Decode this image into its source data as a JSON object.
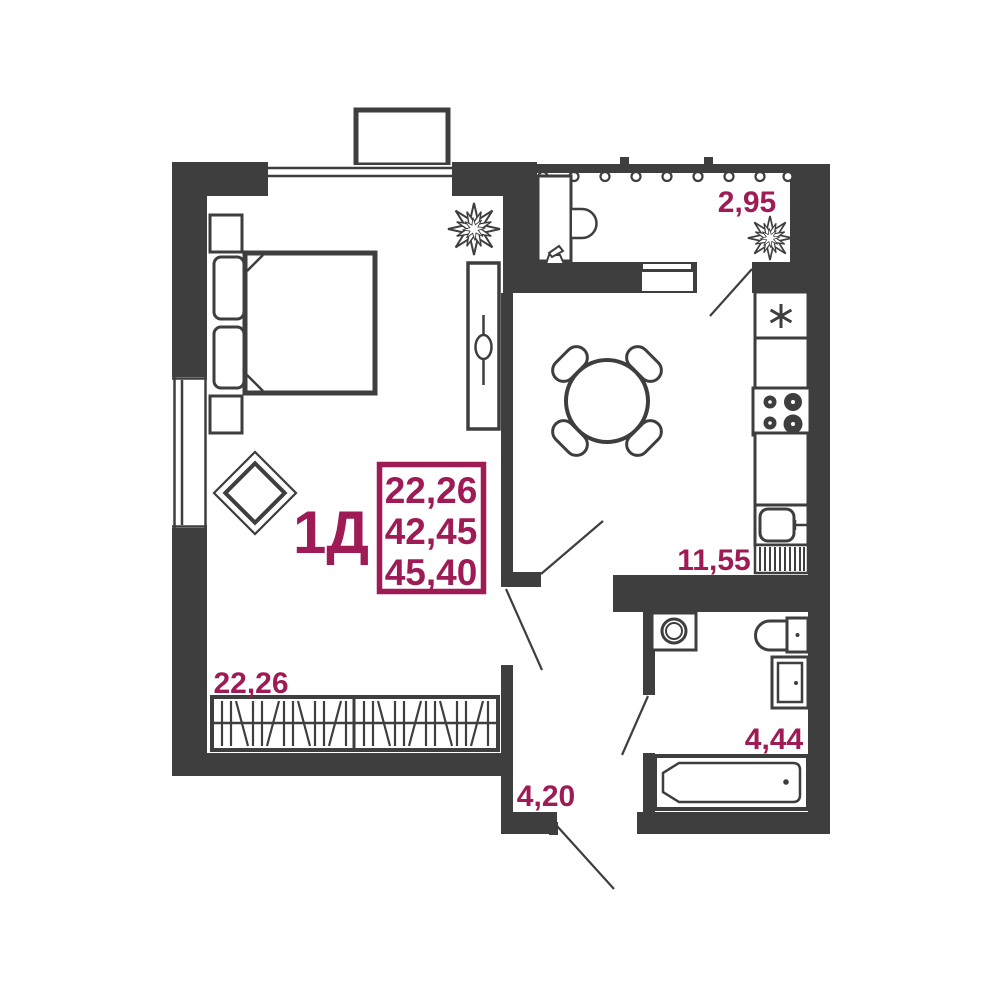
{
  "plan": {
    "unit_type": "1Д",
    "area_summary": {
      "living_space": "22,26",
      "area_without_balcony": "42,45",
      "total_area": "45,40"
    },
    "room_areas": {
      "living_room": "22,26",
      "kitchen": "11,55",
      "balcony": "2,95",
      "bathroom": "4,44",
      "hallway": "4,20"
    },
    "colors": {
      "walls": "#3E3E3E",
      "accent": "#9E1B55",
      "background": "#FFFFFF"
    }
  }
}
